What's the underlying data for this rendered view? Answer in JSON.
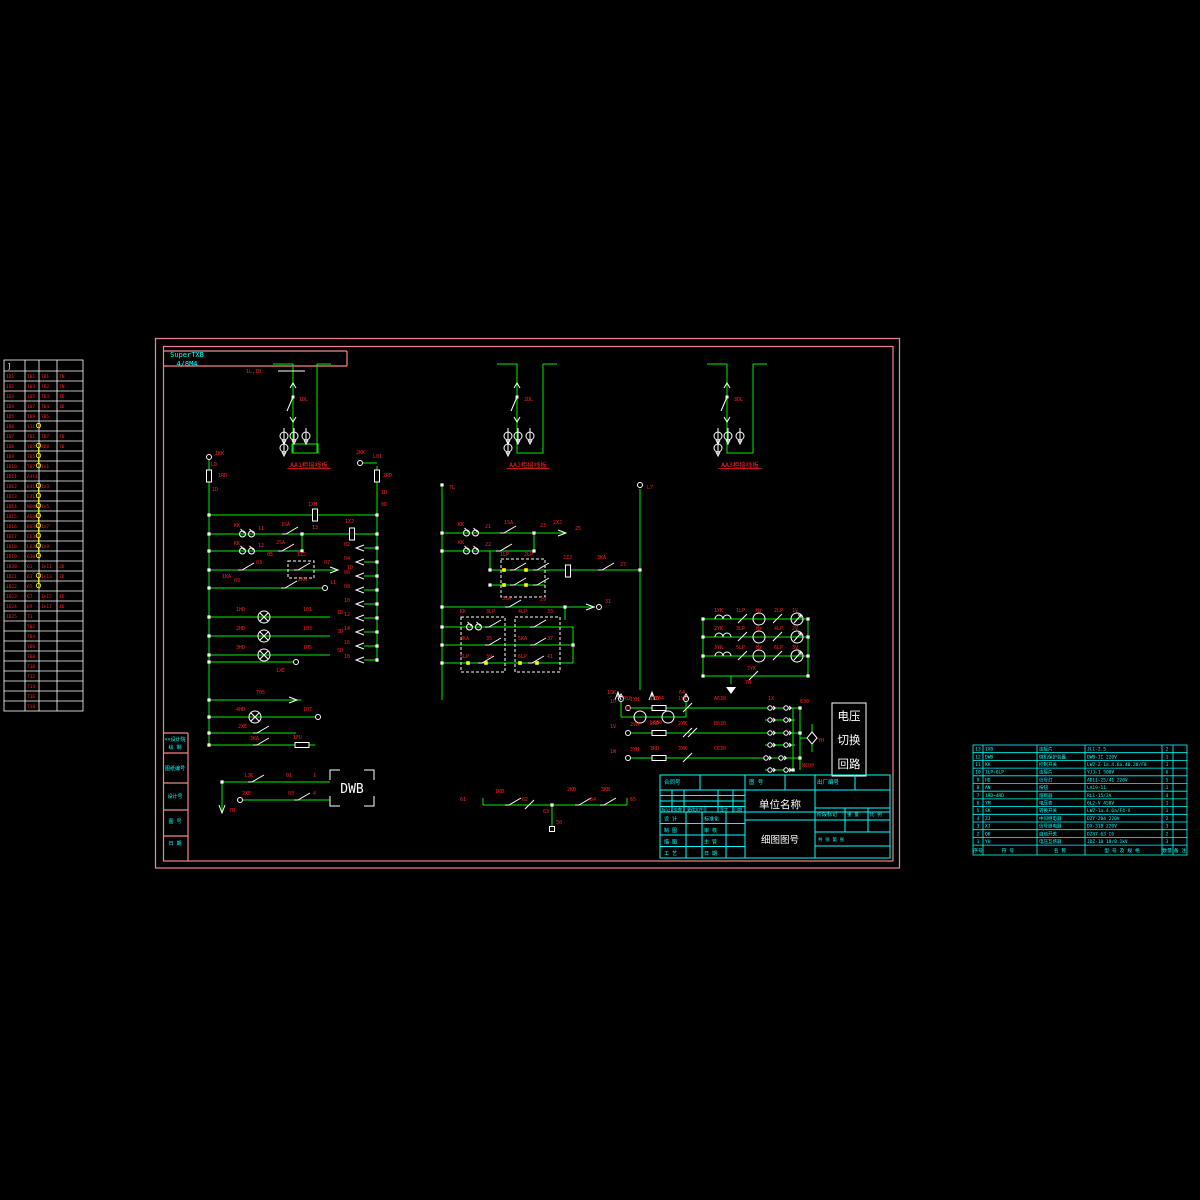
{
  "watermark": {
    "line1": "SuperTXB",
    "line2": "4/8M4"
  },
  "voltage_box": {
    "lines": [
      "电压",
      "切换",
      "回路"
    ]
  },
  "dwb_label": "DWB",
  "title_block": {
    "top": {
      "contract": "合同号",
      "drawing": "图 号",
      "factory": "出厂编号"
    },
    "company": "单位名称",
    "doc": "细图图号",
    "rev": [
      "标记",
      "处数",
      "更改文件号",
      "签字",
      "日期"
    ],
    "rows": [
      [
        "设 计",
        "标准化"
      ],
      [
        "制 图",
        "审 核"
      ],
      [
        "描 图",
        "主 管"
      ],
      [
        "工 艺",
        "日 期"
      ]
    ],
    "stage": "阶段标记",
    "weight": "重 量",
    "scale": "比 例",
    "sheet": "共 张 第 张"
  },
  "left_strip": {
    "cells": [
      "××设计院",
      "绘 制",
      "图纸编号",
      "设计号",
      "图 号",
      "日 期"
    ]
  },
  "bom": {
    "header": [
      "序号",
      "符 号",
      "名 称",
      "型 号 及 规 格",
      "数量",
      "备 注"
    ],
    "rows": [
      [
        "13",
        "1XB",
        "连接片",
        "JL1-2.5",
        "2"
      ],
      [
        "12",
        "DWB",
        "微机保护装置",
        "DWB-II 220V",
        "1"
      ],
      [
        "11",
        "KK",
        "控制开关",
        "LW2-Z-1a.4.6a.40.20/F8",
        "1"
      ],
      [
        "10",
        "1LP~6LP",
        "连接片",
        "YJJ-1 500V",
        "6"
      ],
      [
        "9",
        "HD",
        "信号灯",
        "AD11-25/41 220V",
        "5"
      ],
      [
        "8",
        "AN",
        "按钮",
        "LA19-11",
        "1"
      ],
      [
        "7",
        "1RD~4RD",
        "熔断器",
        "RL1-15/2A",
        "4"
      ],
      [
        "6",
        "YM",
        "电压表",
        "6L2-V 450V",
        "1"
      ],
      [
        "5",
        "SK",
        "转换开关",
        "LW2-1a.4.6a/F4-X",
        "1"
      ],
      [
        "4",
        "ZJ",
        "中间继电器",
        "DZY-204 220V",
        "2"
      ],
      [
        "3",
        "XJ",
        "信号继电器",
        "DX-31B 220V",
        "3"
      ],
      [
        "2",
        "QK",
        "自动开关",
        "DZ47-63 C6",
        "2"
      ],
      [
        "1",
        "YH",
        "电压互感器",
        "JDZ-10 10/0.1kV",
        "3"
      ]
    ]
  },
  "terminal_table": {
    "header": "]",
    "rows": [
      [
        "1D1",
        "101",
        "7D1",
        "7N",
        0
      ],
      [
        "1D2",
        "103",
        "7D2",
        "7N",
        0
      ],
      [
        "1D3",
        "105",
        "7D3",
        "1D",
        0
      ],
      [
        "1D4",
        "107",
        "7D4",
        "1D",
        0
      ],
      [
        "1D5",
        "109",
        "7D5",
        "",
        0
      ],
      [
        "1D6",
        "111",
        "",
        "",
        1
      ],
      [
        "1D7",
        "701",
        "7D7",
        "70",
        0
      ],
      [
        "1D8",
        "703",
        "7D8",
        "70",
        1
      ],
      [
        "1D9",
        "705",
        "",
        "",
        1
      ],
      [
        "1D10",
        "707",
        "1n1",
        "",
        1
      ],
      [
        "1D11",
        "A411",
        "",
        "",
        0
      ],
      [
        "1D12",
        "B411",
        "1n3",
        "",
        1
      ],
      [
        "1D13",
        "C411",
        "",
        "",
        1
      ],
      [
        "1D14",
        "N600",
        "1n5",
        "",
        1
      ],
      [
        "1D15",
        "A630",
        "",
        "",
        1
      ],
      [
        "1D16",
        "B630",
        "1n7",
        "",
        1
      ],
      [
        "1D17",
        "C630",
        "",
        "",
        1
      ],
      [
        "1D18",
        "L630",
        "1n9",
        "",
        1
      ],
      [
        "1D19",
        "630",
        "",
        "",
        1
      ],
      [
        "1D20",
        "61",
        "1n11",
        "2D",
        0
      ],
      [
        "1D21",
        "63",
        "1n13",
        "2D",
        1
      ],
      [
        "1D22",
        "65",
        "",
        "",
        1
      ],
      [
        "1D23",
        "67",
        "1n15",
        "4D",
        0
      ],
      [
        "1D24",
        "69",
        "1n17",
        "4D",
        0
      ],
      [
        "1D25",
        "71",
        "",
        "",
        0
      ],
      [
        "",
        "702",
        "",
        "",
        0
      ],
      [
        "",
        "704",
        "",
        "",
        0
      ],
      [
        "",
        "706",
        "",
        "",
        0
      ],
      [
        "",
        "708",
        "",
        "",
        0
      ],
      [
        "",
        "710",
        "",
        "",
        0
      ],
      [
        "",
        "712",
        "",
        "",
        0
      ],
      [
        "",
        "714",
        "",
        "",
        0
      ],
      [
        "",
        "716",
        "",
        "",
        0
      ],
      [
        "",
        "718",
        "",
        "",
        0
      ]
    ]
  },
  "schematic_labels": [
    {
      "x": 246,
      "y": 373,
      "t": "1L,1B"
    },
    {
      "x": 299,
      "y": 401,
      "t": "1DL"
    },
    {
      "x": 524,
      "y": 401,
      "t": "2DL"
    },
    {
      "x": 734,
      "y": 401,
      "t": "3DL"
    },
    {
      "x": 309,
      "y": 467,
      "t": "AA1柜接线板",
      "a": "m",
      "s": 6.5,
      "u": 1
    },
    {
      "x": 528,
      "y": 467,
      "t": "AA2柜接线板",
      "a": "m",
      "s": 6.5,
      "u": 1
    },
    {
      "x": 740,
      "y": 467,
      "t": "AA3柜接线板",
      "a": "m",
      "s": 6.5,
      "u": 1
    },
    {
      "x": 215,
      "y": 455,
      "t": "1KK"
    },
    {
      "x": 211,
      "y": 466,
      "t": "L0"
    },
    {
      "x": 218,
      "y": 477,
      "t": "1RD"
    },
    {
      "x": 212,
      "y": 491,
      "t": "1D"
    },
    {
      "x": 356,
      "y": 454,
      "t": "2KK"
    },
    {
      "x": 373,
      "y": 458,
      "t": "L01"
    },
    {
      "x": 383,
      "y": 477,
      "t": "2RD"
    },
    {
      "x": 381,
      "y": 494,
      "t": "1D"
    },
    {
      "x": 381,
      "y": 506,
      "t": "0D"
    },
    {
      "x": 308,
      "y": 506,
      "t": "1XM"
    },
    {
      "x": 234,
      "y": 527,
      "t": "KK"
    },
    {
      "x": 258,
      "y": 530,
      "t": "11"
    },
    {
      "x": 281,
      "y": 526,
      "t": "1SA"
    },
    {
      "x": 345,
      "y": 523,
      "t": "1XJ"
    },
    {
      "x": 312,
      "y": 529,
      "t": "13"
    },
    {
      "x": 234,
      "y": 545,
      "t": "KK"
    },
    {
      "x": 258,
      "y": 547,
      "t": "12"
    },
    {
      "x": 276,
      "y": 544,
      "t": "2SA"
    },
    {
      "x": 222,
      "y": 578,
      "t": "1KA"
    },
    {
      "x": 256,
      "y": 564,
      "t": "03"
    },
    {
      "x": 267,
      "y": 556,
      "t": "05"
    },
    {
      "x": 297,
      "y": 556,
      "t": "1ZJ"
    },
    {
      "x": 324,
      "y": 564,
      "t": "07"
    },
    {
      "x": 347,
      "y": 569,
      "t": "1D"
    },
    {
      "x": 234,
      "y": 582,
      "t": "09"
    },
    {
      "x": 298,
      "y": 581,
      "t": "2KA"
    },
    {
      "x": 330,
      "y": 584,
      "t": "11"
    },
    {
      "x": 236,
      "y": 611,
      "t": "1HD"
    },
    {
      "x": 303,
      "y": 611,
      "t": "101"
    },
    {
      "x": 337,
      "y": 614,
      "t": "1D"
    },
    {
      "x": 236,
      "y": 630,
      "t": "2HD"
    },
    {
      "x": 303,
      "y": 630,
      "t": "103"
    },
    {
      "x": 337,
      "y": 633,
      "t": "3D"
    },
    {
      "x": 236,
      "y": 649,
      "t": "3HD"
    },
    {
      "x": 303,
      "y": 649,
      "t": "105"
    },
    {
      "x": 337,
      "y": 652,
      "t": "5D"
    },
    {
      "x": 276,
      "y": 672,
      "t": "1XE"
    },
    {
      "x": 256,
      "y": 694,
      "t": "705"
    },
    {
      "x": 236,
      "y": 711,
      "t": "4HD"
    },
    {
      "x": 303,
      "y": 711,
      "t": "107"
    },
    {
      "x": 238,
      "y": 728,
      "t": "2XE"
    },
    {
      "x": 250,
      "y": 740,
      "t": "3KA"
    },
    {
      "x": 293,
      "y": 739,
      "t": "1FU"
    },
    {
      "x": 344,
      "y": 546,
      "t": "02"
    },
    {
      "x": 344,
      "y": 560,
      "t": "04"
    },
    {
      "x": 344,
      "y": 574,
      "t": "06"
    },
    {
      "x": 344,
      "y": 588,
      "t": "08"
    },
    {
      "x": 344,
      "y": 602,
      "t": "10"
    },
    {
      "x": 344,
      "y": 616,
      "t": "12"
    },
    {
      "x": 344,
      "y": 630,
      "t": "14"
    },
    {
      "x": 344,
      "y": 644,
      "t": "16"
    },
    {
      "x": 344,
      "y": 658,
      "t": "18"
    },
    {
      "x": 449,
      "y": 489,
      "t": "7L"
    },
    {
      "x": 647,
      "y": 489,
      "t": "L7"
    },
    {
      "x": 458,
      "y": 526,
      "t": "KK"
    },
    {
      "x": 485,
      "y": 528,
      "t": "21"
    },
    {
      "x": 504,
      "y": 524,
      "t": "1SA"
    },
    {
      "x": 540,
      "y": 527,
      "t": "23"
    },
    {
      "x": 553,
      "y": 524,
      "t": "2XJ"
    },
    {
      "x": 575,
      "y": 530,
      "t": "25"
    },
    {
      "x": 458,
      "y": 544,
      "t": "KK"
    },
    {
      "x": 485,
      "y": 546,
      "t": "22"
    },
    {
      "x": 500,
      "y": 556,
      "t": "1LP"
    },
    {
      "x": 524,
      "y": 556,
      "t": "2LP"
    },
    {
      "x": 563,
      "y": 559,
      "t": "2ZJ"
    },
    {
      "x": 597,
      "y": 559,
      "t": "3KA"
    },
    {
      "x": 620,
      "y": 566,
      "t": "27"
    },
    {
      "x": 502,
      "y": 600,
      "t": "3SA"
    },
    {
      "x": 540,
      "y": 601,
      "t": "29"
    },
    {
      "x": 605,
      "y": 603,
      "t": "31"
    },
    {
      "x": 460,
      "y": 613,
      "t": "KK"
    },
    {
      "x": 486,
      "y": 613,
      "t": "3LP"
    },
    {
      "x": 518,
      "y": 613,
      "t": "4LP"
    },
    {
      "x": 547,
      "y": 613,
      "t": "33"
    },
    {
      "x": 460,
      "y": 640,
      "t": "4KA"
    },
    {
      "x": 486,
      "y": 640,
      "t": "35"
    },
    {
      "x": 518,
      "y": 640,
      "t": "5KA"
    },
    {
      "x": 547,
      "y": 640,
      "t": "37"
    },
    {
      "x": 460,
      "y": 658,
      "t": "5LP"
    },
    {
      "x": 486,
      "y": 658,
      "t": "39"
    },
    {
      "x": 518,
      "y": 658,
      "t": "6LP"
    },
    {
      "x": 547,
      "y": 658,
      "t": "41"
    },
    {
      "x": 622,
      "y": 700,
      "t": "702"
    },
    {
      "x": 655,
      "y": 700,
      "t": "704"
    },
    {
      "x": 714,
      "y": 612,
      "t": "1YK"
    },
    {
      "x": 736,
      "y": 612,
      "t": "1LP"
    },
    {
      "x": 756,
      "y": 612,
      "t": "Hz"
    },
    {
      "x": 774,
      "y": 612,
      "t": "2LP"
    },
    {
      "x": 792,
      "y": 612,
      "t": "1V"
    },
    {
      "x": 714,
      "y": 630,
      "t": "2YK"
    },
    {
      "x": 736,
      "y": 630,
      "t": "3LP"
    },
    {
      "x": 756,
      "y": 630,
      "t": "Hz"
    },
    {
      "x": 774,
      "y": 630,
      "t": "4LP"
    },
    {
      "x": 792,
      "y": 630,
      "t": "2V"
    },
    {
      "x": 714,
      "y": 649,
      "t": "3YK"
    },
    {
      "x": 736,
      "y": 649,
      "t": "5LP"
    },
    {
      "x": 756,
      "y": 649,
      "t": "Hz"
    },
    {
      "x": 774,
      "y": 649,
      "t": "6LP"
    },
    {
      "x": 792,
      "y": 649,
      "t": "3V"
    },
    {
      "x": 747,
      "y": 670,
      "t": "7YK"
    },
    {
      "x": 745,
      "y": 684,
      "t": "7N"
    },
    {
      "x": 610,
      "y": 703,
      "t": "1U"
    },
    {
      "x": 630,
      "y": 701,
      "t": "1YH"
    },
    {
      "x": 650,
      "y": 700,
      "t": "1RD"
    },
    {
      "x": 678,
      "y": 700,
      "t": "1YK"
    },
    {
      "x": 714,
      "y": 700,
      "t": "A630"
    },
    {
      "x": 768,
      "y": 700,
      "t": "1X"
    },
    {
      "x": 610,
      "y": 728,
      "t": "1V"
    },
    {
      "x": 630,
      "y": 726,
      "t": "2YH"
    },
    {
      "x": 650,
      "y": 725,
      "t": "2RD"
    },
    {
      "x": 678,
      "y": 725,
      "t": "2YK"
    },
    {
      "x": 714,
      "y": 725,
      "t": "B630"
    },
    {
      "x": 610,
      "y": 753,
      "t": "1W"
    },
    {
      "x": 630,
      "y": 751,
      "t": "3YH"
    },
    {
      "x": 650,
      "y": 750,
      "t": "3RD"
    },
    {
      "x": 678,
      "y": 750,
      "t": "3YK"
    },
    {
      "x": 714,
      "y": 750,
      "t": "C630"
    },
    {
      "x": 818,
      "y": 742,
      "t": "YH"
    },
    {
      "x": 800,
      "y": 703,
      "t": "630"
    },
    {
      "x": 802,
      "y": 767,
      "t": "N600"
    },
    {
      "x": 607,
      "y": 694,
      "t": "1SK"
    },
    {
      "x": 625,
      "y": 710,
      "t": "63"
    },
    {
      "x": 650,
      "y": 724,
      "t": "L630"
    },
    {
      "x": 679,
      "y": 694,
      "t": "64"
    },
    {
      "x": 460,
      "y": 801,
      "t": "61"
    },
    {
      "x": 495,
      "y": 793,
      "t": "1KB"
    },
    {
      "x": 522,
      "y": 801,
      "t": "62"
    },
    {
      "x": 543,
      "y": 813,
      "t": "63"
    },
    {
      "x": 556,
      "y": 824,
      "t": "50"
    },
    {
      "x": 567,
      "y": 791,
      "t": "2KB"
    },
    {
      "x": 590,
      "y": 801,
      "t": "64"
    },
    {
      "x": 601,
      "y": 791,
      "t": "3KB"
    },
    {
      "x": 630,
      "y": 801,
      "t": "65"
    },
    {
      "x": 229,
      "y": 812,
      "t": "7N"
    },
    {
      "x": 244,
      "y": 777,
      "t": "1JK"
    },
    {
      "x": 286,
      "y": 777,
      "t": "01"
    },
    {
      "x": 313,
      "y": 777,
      "t": "1"
    },
    {
      "x": 242,
      "y": 795,
      "t": "2XE"
    },
    {
      "x": 288,
      "y": 795,
      "t": "03"
    },
    {
      "x": 313,
      "y": 795,
      "t": "4"
    },
    {
      "x": 175,
      "y": 741,
      "t": "××设计院",
      "c": "c",
      "a": "m"
    },
    {
      "x": 175,
      "y": 749,
      "t": "绘 制",
      "c": "c",
      "a": "m"
    },
    {
      "x": 175,
      "y": 770,
      "t": "图纸编号",
      "c": "c",
      "a": "m"
    },
    {
      "x": 175,
      "y": 798,
      "t": "设计号",
      "c": "c",
      "a": "m"
    },
    {
      "x": 175,
      "y": 823,
      "t": "图 号",
      "c": "c",
      "a": "m"
    },
    {
      "x": 175,
      "y": 845,
      "t": "日 期",
      "c": "c",
      "a": "m"
    }
  ]
}
